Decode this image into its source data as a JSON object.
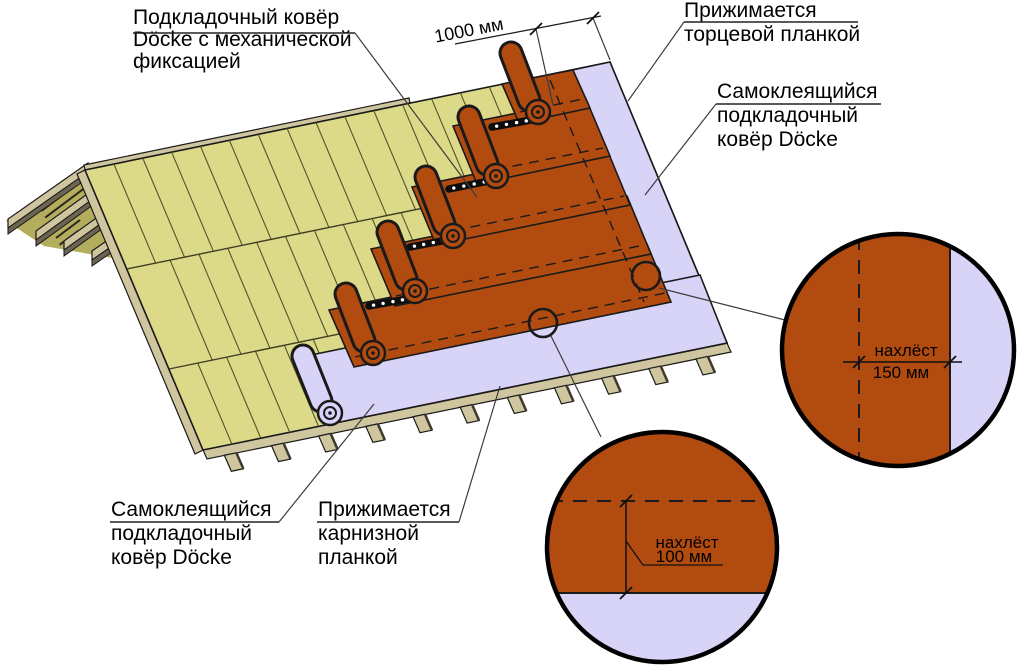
{
  "labels": {
    "underlayment_mechanical": {
      "lines": [
        "Подкладочный ковёр",
        "Döcke с механической",
        "фиксацией"
      ]
    },
    "pressed_end_strip": {
      "lines": [
        "Прижимается",
        "торцевой планкой"
      ]
    },
    "selfadhesive_gable": {
      "lines": [
        "Самоклеящийся",
        "подкладочный",
        "ковёр Döcke"
      ]
    },
    "selfadhesive_eaves": {
      "lines": [
        "Самоклеящийся",
        "подкладочный",
        "ковёр Döcke"
      ]
    },
    "pressed_eaves_strip": {
      "lines": [
        "Прижимается",
        "карнизной",
        "планкой"
      ]
    }
  },
  "dimensions": {
    "roll_width": "1000 мм",
    "side_overlap": {
      "caption": "нахлёст",
      "value": "150 мм"
    },
    "end_overlap": {
      "caption": "нахлёст",
      "value": "100 мм"
    }
  },
  "colors": {
    "underlayment": "#b24b10",
    "self_adhesive_carpet": "#d7d4f7",
    "roof_deck": "#dcda88",
    "wood": "#cfc6a0",
    "outline": "#1a1a1a"
  }
}
